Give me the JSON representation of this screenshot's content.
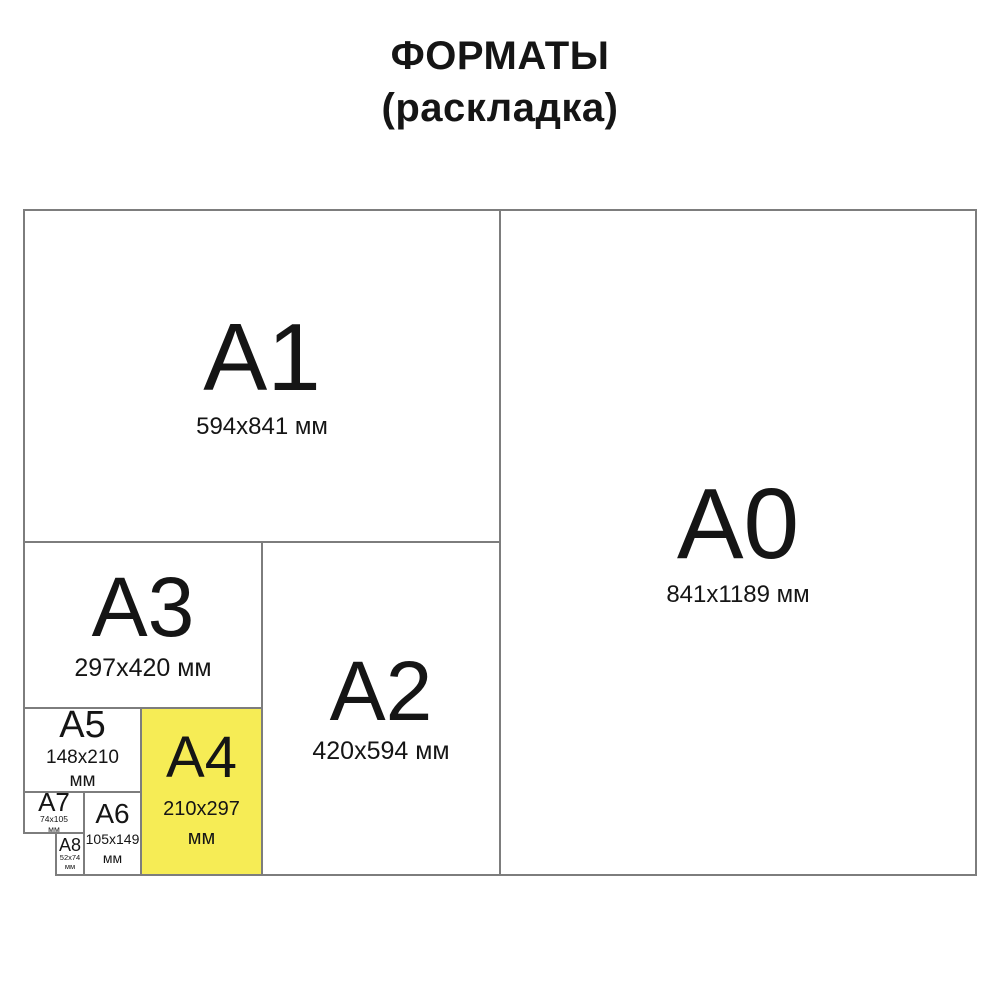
{
  "title": {
    "line1": "ФОРМАТЫ",
    "line2": "(раскладка)"
  },
  "colors": {
    "highlight_yellow": "#f6ec55",
    "line_gray": "#7d7d7d",
    "text_black": "#151515",
    "background": "#ffffff"
  },
  "formats": [
    {
      "name": "A1",
      "dims": "594x841 мм"
    },
    {
      "name": "A0",
      "dims": "841x1189 мм"
    },
    {
      "name": "A3",
      "dims": "297x420 мм"
    },
    {
      "name": "A2",
      "dims": "420x594 мм"
    },
    {
      "name": "A5",
      "dims_line1": "148x210",
      "dims_line2": "мм"
    },
    {
      "name": "A4",
      "dims_line1": "210x297",
      "dims_line2": "мм",
      "highlighted": true
    },
    {
      "name": "A7",
      "dims_line1": "74x105",
      "dims_line2": "мм"
    },
    {
      "name": "A6",
      "dims_line1": "105x149",
      "dims_line2": "мм"
    },
    {
      "name": "A8",
      "dims_line1": "52x74",
      "dims_line2": "мм"
    }
  ]
}
